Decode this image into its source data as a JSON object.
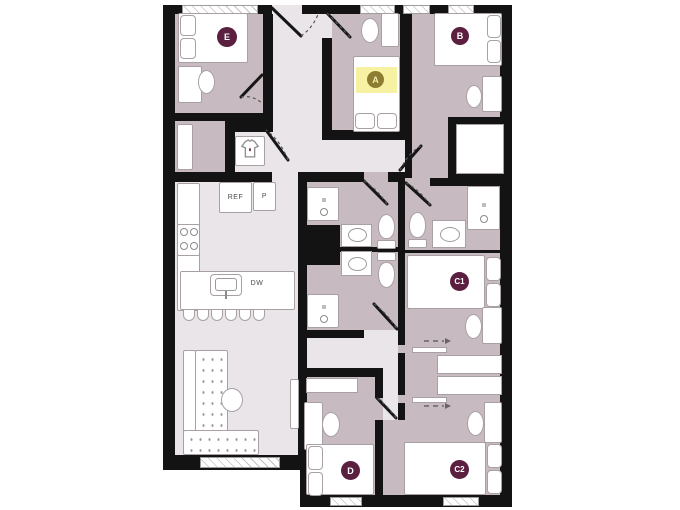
{
  "plan_name": "Unit floor plan",
  "rooms": {
    "A": {
      "label": "A",
      "highlighted": true
    },
    "B": {
      "label": "B",
      "highlighted": false
    },
    "C1": {
      "label": "C1",
      "highlighted": false
    },
    "C2": {
      "label": "C2",
      "highlighted": false
    },
    "D": {
      "label": "D",
      "highlighted": false
    },
    "E": {
      "label": "E",
      "highlighted": false
    }
  },
  "kitchen": {
    "fridge_label": "REF",
    "pantry_label": "P",
    "dishwasher_label": "DW"
  },
  "icons": {
    "laundry": "shirt-icon",
    "door_swings": "quarter-arc-dashed",
    "sliding_door_arrows": "dashed-arrow-right"
  },
  "colors": {
    "wall": "#131313",
    "room_floor": "#c7bac0",
    "hall_floor": "#eae5e9",
    "furniture": "#ffffff",
    "highlight": "#f6f1a3",
    "label_bg": "#5b2040",
    "label_a_bg": "#8d7d33"
  }
}
